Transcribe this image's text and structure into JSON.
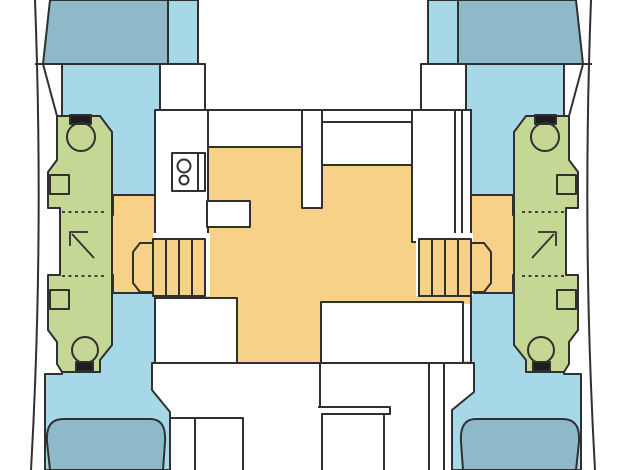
{
  "diagram": {
    "kind": "catamaran-deck-floor-plan",
    "orientation": "bow-up"
  },
  "colors": {
    "background": "#ffffff",
    "deck_white": "#ffffff",
    "cabin_floor_blue": "#a6d8e8",
    "berth_blue": "#8db9c8",
    "heads_green": "#c4d795",
    "salon_floor_orange": "#f8d189",
    "fixture_black": "#1d1d1d",
    "outline": "#303030"
  },
  "icons": {
    "toilet": "circle-bowl-with-black-tank",
    "shower_direction": "corner-arrow",
    "stairs": "treads-with-chamfered-end",
    "stove": "two-burner-circles",
    "sink": "rectangle-basin",
    "berth": "rounded-mattress-shape",
    "door": "dotted-line"
  }
}
